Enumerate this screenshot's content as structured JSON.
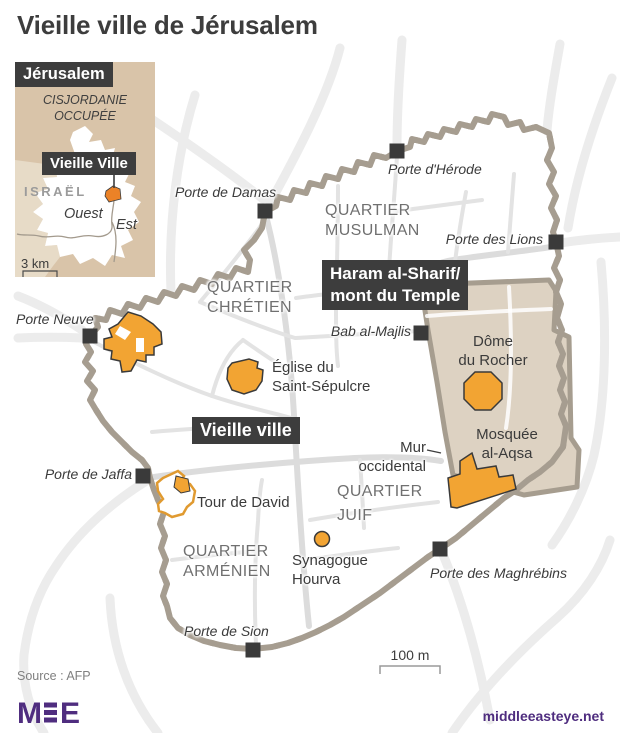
{
  "title": "Vieille ville de Jérusalem",
  "inset": {
    "title": "Jérusalem",
    "region": "CISJORDANIE\nOCCUPÉE",
    "old_city": "Vieille Ville",
    "country": "ISRAËL",
    "west": "Ouest",
    "east": "Est",
    "scale": "3 km"
  },
  "map": {
    "highlight": {
      "old_city": "Vieille ville",
      "haram": "Haram al-Sharif/\nmont du Temple"
    },
    "quarters": [
      {
        "id": "musulman",
        "label": "QUARTIER\nMUSULMAN"
      },
      {
        "id": "chretien",
        "label": "QUARTIER\nCHRÉTIEN"
      },
      {
        "id": "juif",
        "label": "QUARTIER\nJUIF"
      },
      {
        "id": "armenien",
        "label": "QUARTIER\nARMÉNIEN"
      }
    ],
    "gates": [
      {
        "id": "damas",
        "label": "Porte de Damas"
      },
      {
        "id": "herode",
        "label": "Porte d'Hérode"
      },
      {
        "id": "lions",
        "label": "Porte des Lions"
      },
      {
        "id": "neuve",
        "label": "Porte Neuve"
      },
      {
        "id": "majlis",
        "label": "Bab al-Majlis"
      },
      {
        "id": "jaffa",
        "label": "Porte de Jaffa"
      },
      {
        "id": "sion",
        "label": "Porte de Sion"
      },
      {
        "id": "maghrebins",
        "label": "Porte des Maghrébins"
      }
    ],
    "landmarks": [
      {
        "id": "sepulcre",
        "label": "Église du\nSaint-Sépulcre"
      },
      {
        "id": "dome",
        "label": "Dôme\ndu Rocher"
      },
      {
        "id": "aqsa",
        "label": "Mosquée\nal-Aqsa"
      },
      {
        "id": "david",
        "label": "Tour de David"
      },
      {
        "id": "hourva",
        "label": "Synagogue\nHourva"
      },
      {
        "id": "mur",
        "label": "Mur\noccidental"
      }
    ],
    "scale": "100 m"
  },
  "footer": {
    "source": "Source : AFP",
    "logo": "MEE",
    "site": "middleeasteye.net"
  },
  "colors": {
    "orange": "#F2A433",
    "inset_orange": "#EB8227",
    "wall": "#A69D90",
    "gate": "#3A3A3A",
    "dark_box": "#3D3D3D",
    "haram_fill": "#DDD2C2",
    "inset_tan": "#D9C4A9",
    "purple": "#4F2D7F"
  }
}
